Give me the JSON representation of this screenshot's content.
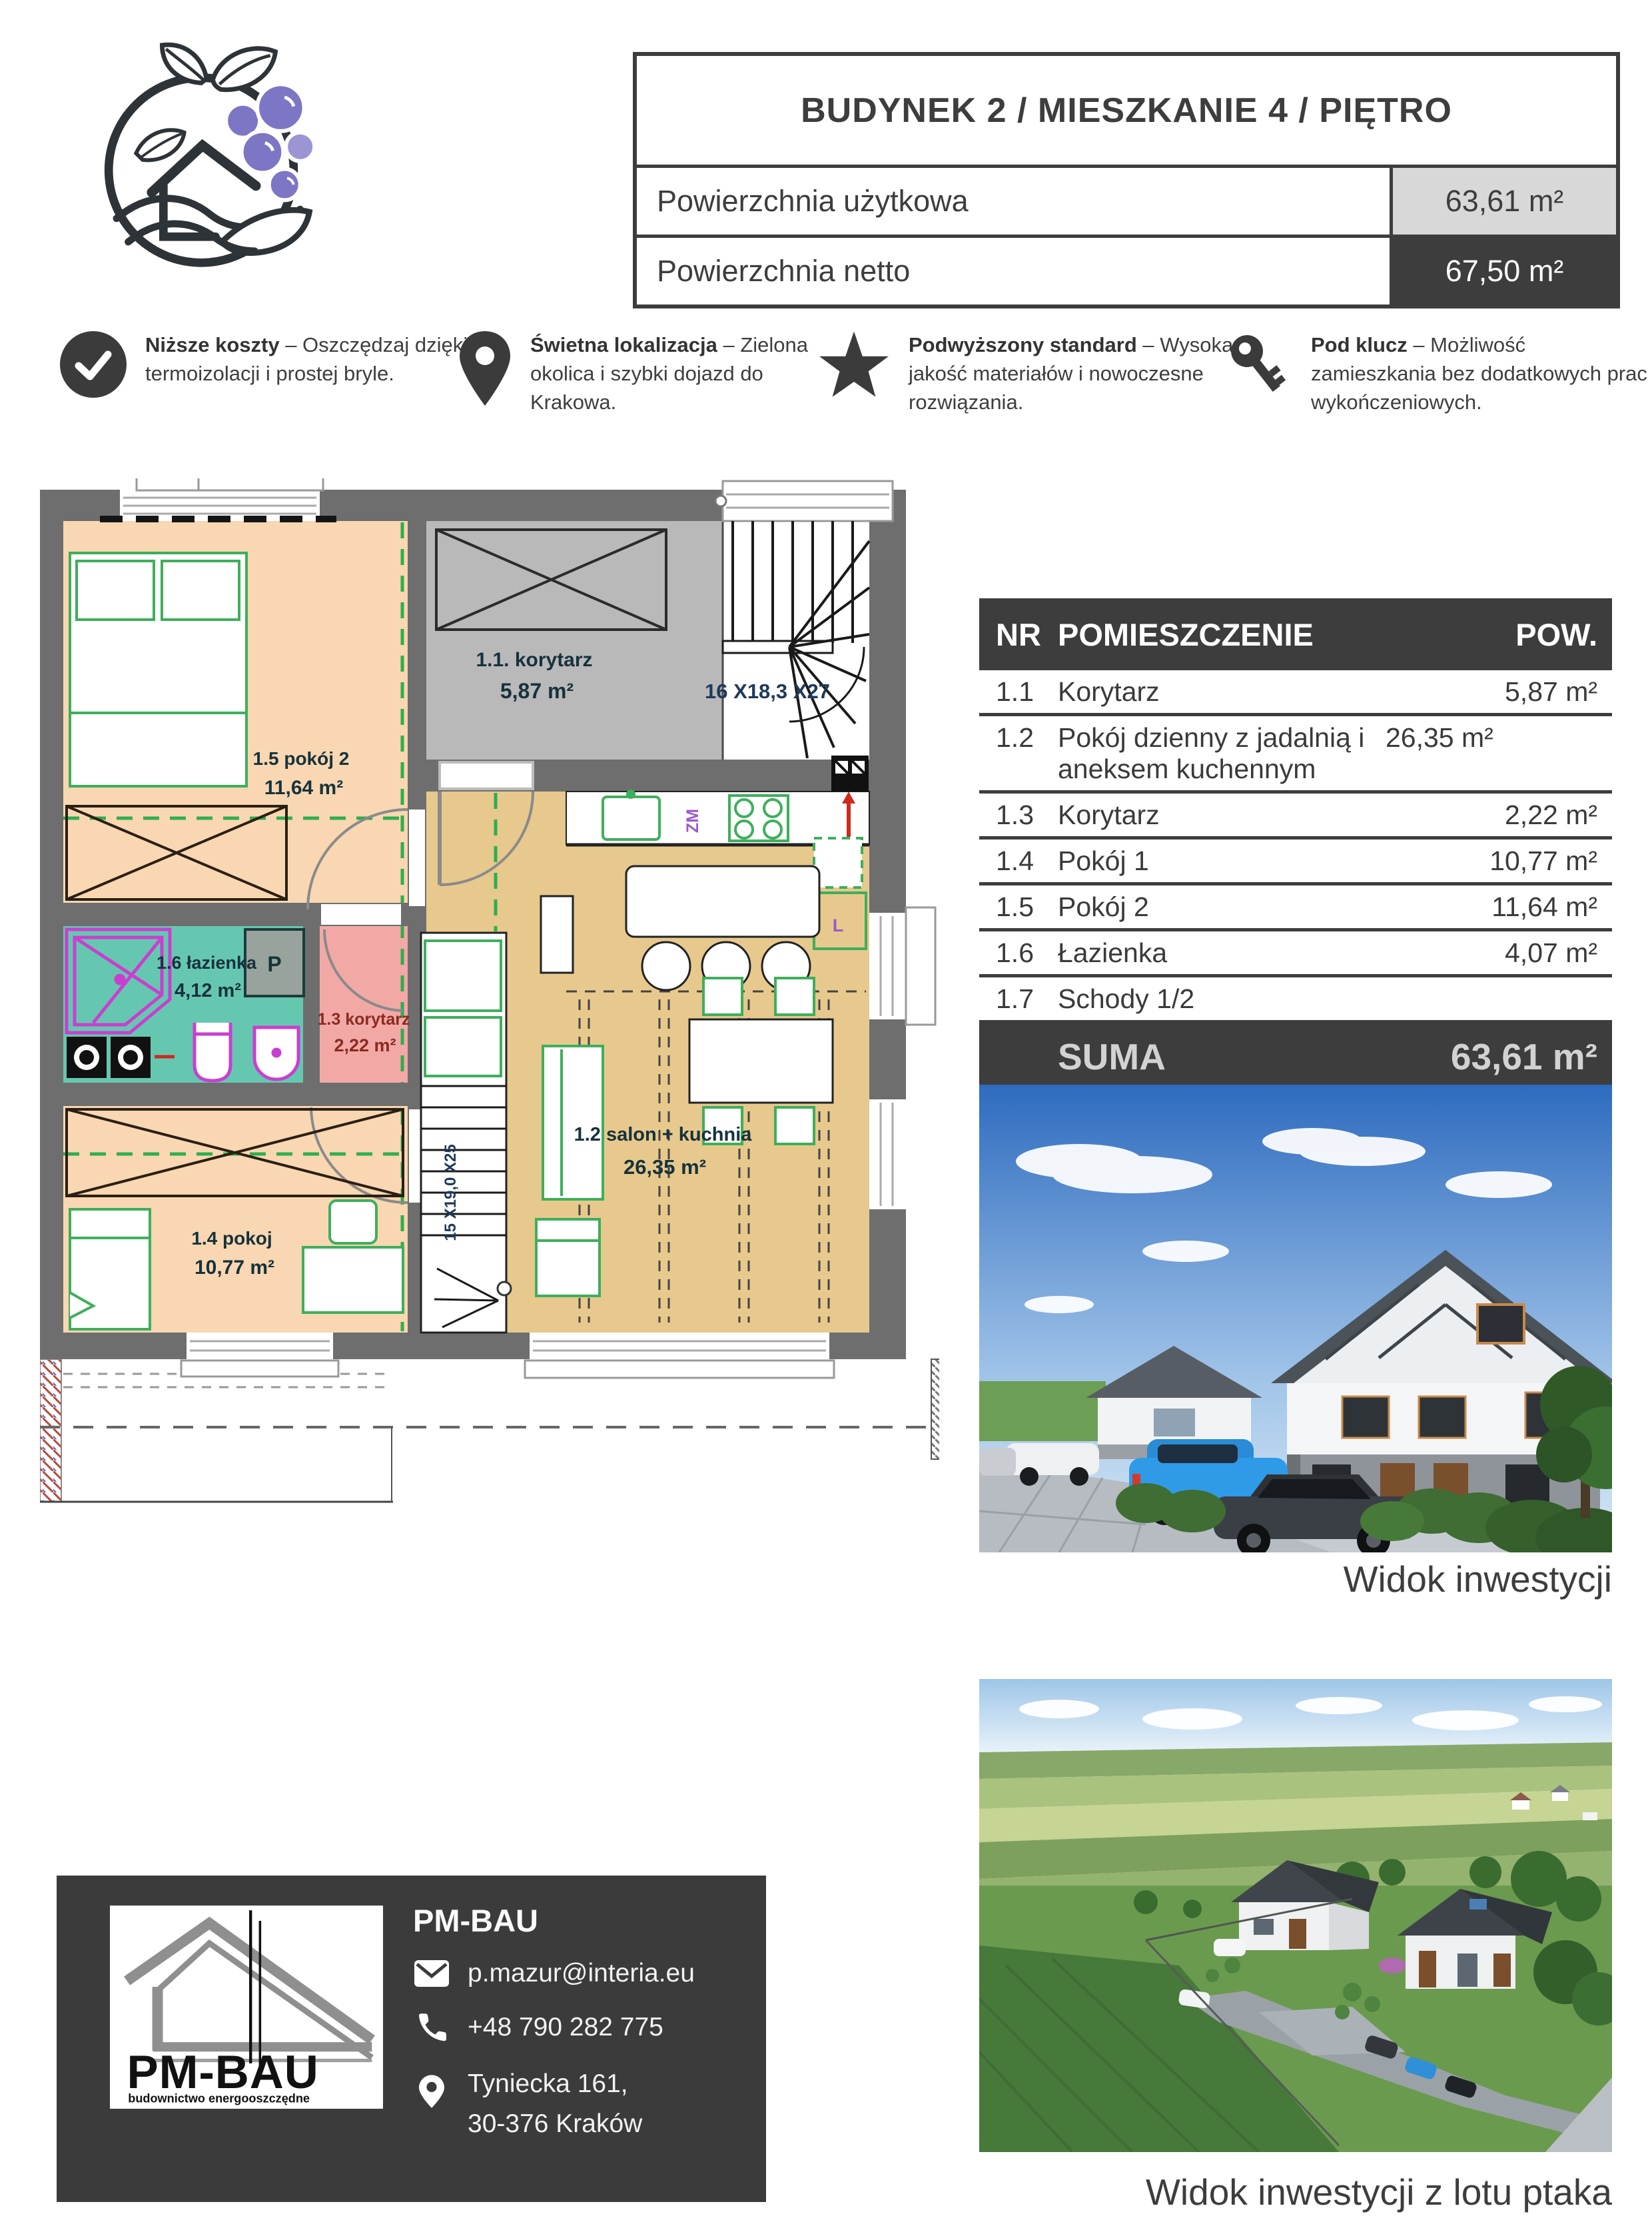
{
  "spec_table": {
    "title": "BUDYNEK 2 / MIESZKANIE 4 / PIĘTRO",
    "rows": [
      {
        "label": "Powierzchnia użytkowa",
        "value": "63,61 m²"
      },
      {
        "label": "Powierzchnia netto",
        "value": "67,50 m²"
      }
    ]
  },
  "features": [
    {
      "icon": "check-icon",
      "title": "Niższe koszty",
      "text": "– Oszczędzaj dzięki termoizolacji i prostej bryle."
    },
    {
      "icon": "location-pin-icon",
      "title": "Świetna lokalizacja",
      "text": "– Zielona okolica i szybki dojazd do Krakowa."
    },
    {
      "icon": "star-icon",
      "title": "Podwyższony standard",
      "text": "– Wysoka jakość materiałów i nowoczesne rozwiązania."
    },
    {
      "icon": "key-icon",
      "title": "Pod klucz",
      "text": "– Możliwość zamieszkania bez dodatkowych prac wykończeniowych."
    }
  ],
  "room_table": {
    "headers": {
      "nr": "NR",
      "name": "POMIESZCZENIE",
      "area": "POW."
    },
    "rows": [
      {
        "nr": "1.1",
        "name": "Korytarz",
        "area": "5,87 m²"
      },
      {
        "nr": "1.2",
        "name": "Pokój dzienny z jadalnią i aneksem kuchennym",
        "area": "26,35 m²"
      },
      {
        "nr": "1.3",
        "name": "Korytarz",
        "area": "2,22 m²"
      },
      {
        "nr": "1.4",
        "name": "Pokój 1",
        "area": "10,77 m²"
      },
      {
        "nr": "1.5",
        "name": "Pokój 2",
        "area": "11,64 m²"
      },
      {
        "nr": "1.6",
        "name": "Łazienka",
        "area": "4,07 m²"
      },
      {
        "nr": "1.7",
        "name": "Schody 1/2",
        "area": ""
      }
    ],
    "sum_label": "SUMA",
    "sum_value": "63,61 m²"
  },
  "floorplan": {
    "labels": {
      "room11_name": "1.1. korytarz",
      "room11_area": "5,87 m²",
      "room12_name": "1.2 salon + kuchnia",
      "room12_area": "26,35 m²",
      "room13_name": "1.3 korytarz",
      "room13_area": "2,22 m²",
      "room14_name": "1.4 pokoj",
      "room14_area": "10,77 m²",
      "room15_name": "1.5 pokój 2",
      "room15_area": "11,64 m²",
      "room16_name": "1.6 łazienka",
      "room16_area": "4,12 m²",
      "stairs_top": "16 X18,3 X27",
      "stairs_bottom": "15 X19,0 X25",
      "mark_p": "P",
      "mark_zm": "ZM",
      "mark_l": "L"
    }
  },
  "photos": {
    "view1_caption": "Widok inwestycji",
    "view2_caption": "Widok inwestycji z lotu ptaka"
  },
  "footer": {
    "company": "PM-BAU",
    "logo_text": "PM-BAU",
    "logo_tagline": "budownictwo energooszczędne",
    "email": "p.mazur@interia.eu",
    "phone": "+48 790 282 775",
    "address_line1": "Tyniecka 161,",
    "address_line2": "30-376 Kraków"
  },
  "colors": {
    "dark": "#3b3b3b",
    "wall": "#6e6e6e",
    "peach": "#f8d7b2",
    "tan": "#e7c98d",
    "teal": "#66c7b1",
    "pink": "#f2a9a6",
    "corridor_gray": "#b9b9b9",
    "furniture_green": "#3fae5c",
    "magenta": "#c93fd0",
    "berry_purple": "#7d76c4"
  }
}
